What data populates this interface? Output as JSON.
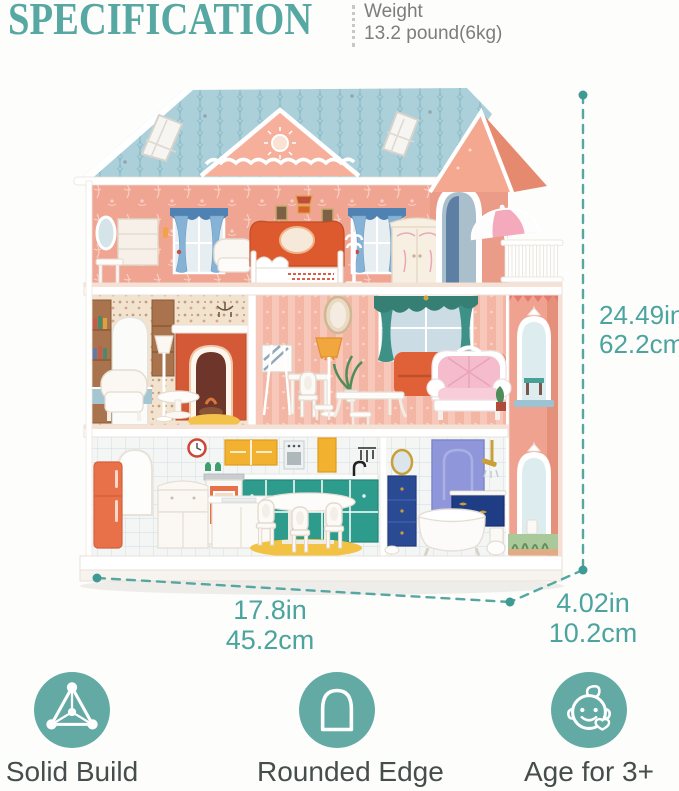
{
  "header": {
    "title": "SPECIFICATION",
    "weight_label": "Weight",
    "weight_value": "13.2 pound(6kg)"
  },
  "dimensions": {
    "height": {
      "inches": "24.49in",
      "cm": "62.2cm"
    },
    "width": {
      "inches": "17.8in",
      "cm": "45.2cm"
    },
    "depth": {
      "inches": "4.02in",
      "cm": "10.2cm"
    }
  },
  "features": [
    {
      "label": "Solid Build",
      "icon": "triangle-structure-icon"
    },
    {
      "label": "Rounded Edge",
      "icon": "arch-icon"
    },
    {
      "label": "Age for 3+",
      "icon": "baby-face-icon"
    }
  ],
  "colors": {
    "accent_teal": "#57a8a2",
    "dimension_text": "#4ba49e",
    "weight_text": "#7d7d7d",
    "feature_label": "#454e4d",
    "roof_blue": "#a9cfd9",
    "wall_pink": "#efa290"
  }
}
